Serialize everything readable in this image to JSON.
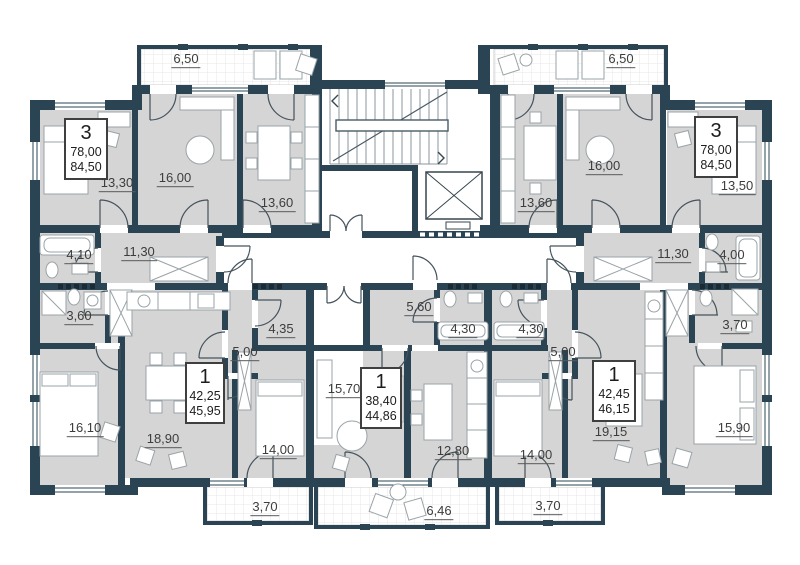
{
  "colors": {
    "wall": "#2a4454",
    "room_fill": "#d5d5d5",
    "balcony_fill": "#ffffff",
    "label_text": "#3d3d3d"
  },
  "apartments": [
    {
      "id": "apt-3-left",
      "rooms": "3",
      "area_living": "78,00",
      "area_total": "84,50"
    },
    {
      "id": "apt-3-right",
      "rooms": "3",
      "area_living": "78,00",
      "area_total": "84,50"
    },
    {
      "id": "apt-1-left",
      "rooms": "1",
      "area_living": "42,25",
      "area_total": "45,95"
    },
    {
      "id": "apt-1-middle",
      "rooms": "1",
      "area_living": "38,40",
      "area_total": "44,86"
    },
    {
      "id": "apt-1-right",
      "rooms": "1",
      "area_living": "42,45",
      "area_total": "46,15"
    }
  ],
  "labels": [
    {
      "name": "balcony-top-left",
      "area": "6,50"
    },
    {
      "name": "room-13-30",
      "area": "13,30"
    },
    {
      "name": "room-16-00-left",
      "area": "16,00"
    },
    {
      "name": "room-13-60-left",
      "area": "13,60"
    },
    {
      "name": "bath-4-10",
      "area": "4,10"
    },
    {
      "name": "hall-11-30-left",
      "area": "11,30"
    },
    {
      "name": "bath-3-60",
      "area": "3,60"
    },
    {
      "name": "bedroom-16-10",
      "area": "16,10"
    },
    {
      "name": "balcony-top-right",
      "area": "6,50"
    },
    {
      "name": "room-16-00-right",
      "area": "16,00"
    },
    {
      "name": "room-13-60-right",
      "area": "13,60"
    },
    {
      "name": "room-13-50",
      "area": "13,50"
    },
    {
      "name": "hall-11-30-right",
      "area": "11,30"
    },
    {
      "name": "bath-4-00",
      "area": "4,00"
    },
    {
      "name": "bath-3-70-right",
      "area": "3,70"
    },
    {
      "name": "bedroom-15-90",
      "area": "15,90"
    },
    {
      "name": "kitchen-living-18-90",
      "area": "18,90"
    },
    {
      "name": "bedroom-14-00-left",
      "area": "14,00"
    },
    {
      "name": "bath-4-35",
      "area": "4,35"
    },
    {
      "name": "hall-5-00-left",
      "area": "5,00"
    },
    {
      "name": "living-15-70",
      "area": "15,70"
    },
    {
      "name": "hall-5-60",
      "area": "5,60"
    },
    {
      "name": "bath-4-30-middle",
      "area": "4,30"
    },
    {
      "name": "kitchen-12-80",
      "area": "12,80"
    },
    {
      "name": "bath-4-30-right",
      "area": "4,30"
    },
    {
      "name": "hall-5-00-right",
      "area": "5,00"
    },
    {
      "name": "kitchen-living-19-15",
      "area": "19,15"
    },
    {
      "name": "bedroom-14-00-right",
      "area": "14,00"
    },
    {
      "name": "balcony-bottom-left",
      "area": "3,70"
    },
    {
      "name": "balcony-bottom-center",
      "area": "6,46"
    },
    {
      "name": "balcony-bottom-right",
      "area": "3,70"
    }
  ]
}
